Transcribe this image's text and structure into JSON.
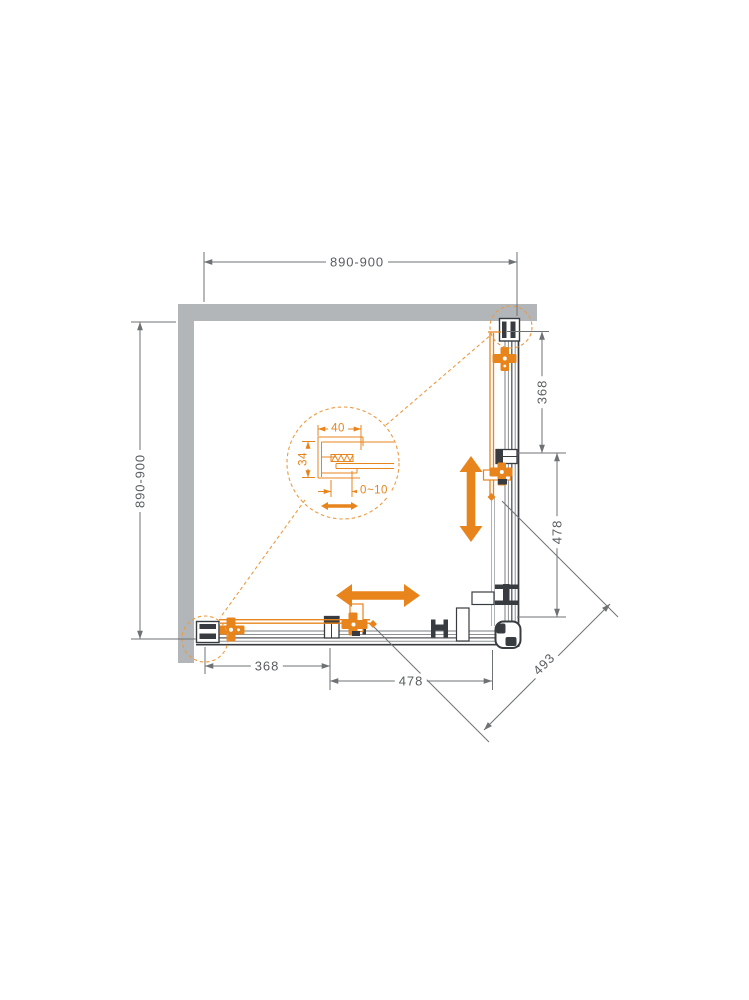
{
  "drawing": {
    "title": "Corner shower enclosure with two sliding doors - plan view dimension drawing",
    "colors": {
      "accent_orange": "#e8841c",
      "dashed_callout_orange": "#ec9a40",
      "wall_gray": "#b3b6b9",
      "frame_dark": "#383c40",
      "frame_mid": "#8d9194",
      "dimension_line": "#6e7275",
      "dimension_text": "#595d60",
      "background": "#ffffff"
    },
    "dimensions": {
      "top_width": {
        "label": "890-900"
      },
      "left_depth": {
        "label": "890-900"
      },
      "right_fixed_panel": {
        "label": "368"
      },
      "right_door_opening": {
        "label": "478"
      },
      "bottom_fixed_panel": {
        "label": "368"
      },
      "bottom_door_opening": {
        "label": "478"
      },
      "diagonal_entry": {
        "label": "493"
      }
    },
    "detail_callout": {
      "profile_width": {
        "label": "40"
      },
      "profile_depth": {
        "label": "34"
      },
      "adjustment_range": {
        "label": "0~10"
      }
    }
  }
}
